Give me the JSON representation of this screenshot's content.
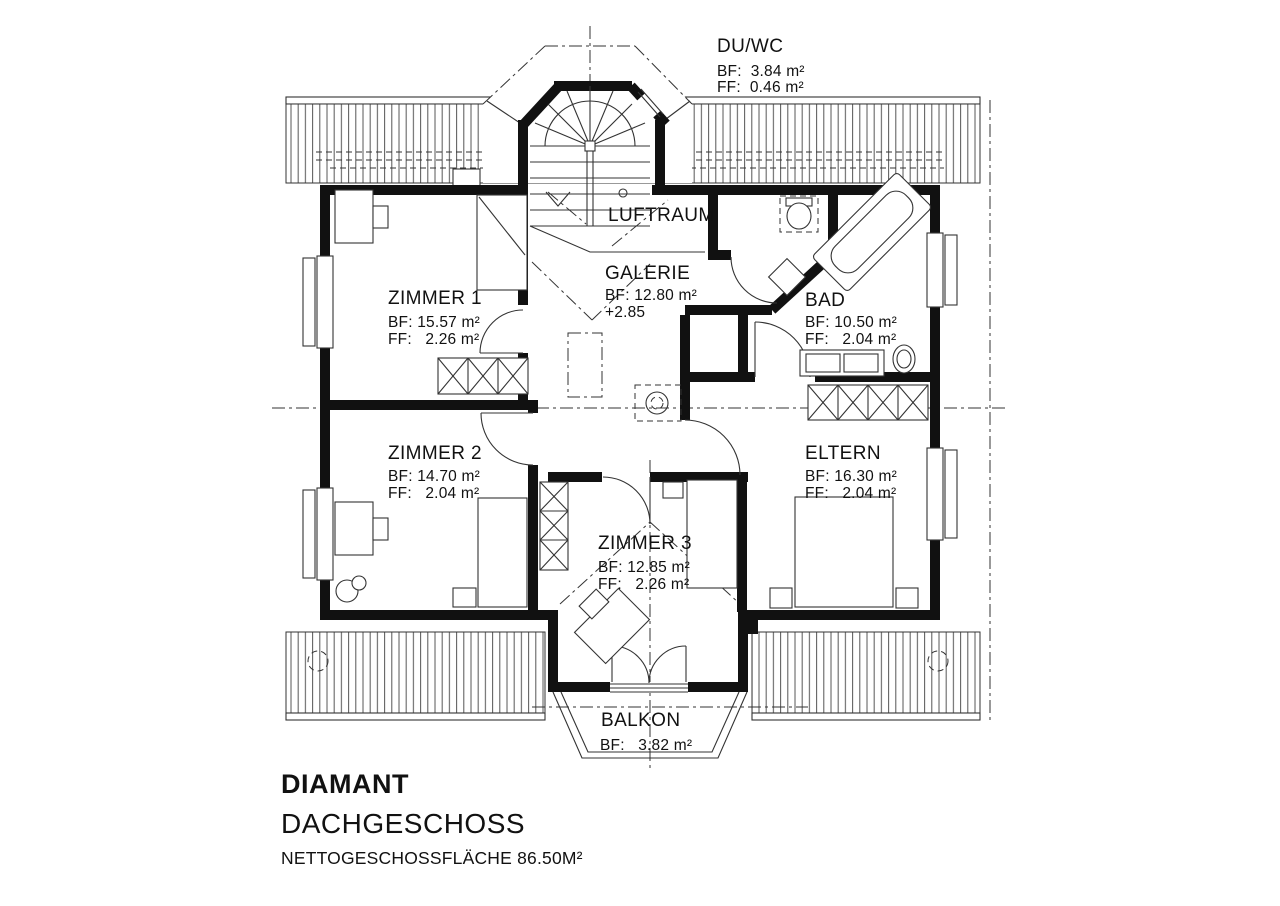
{
  "title": {
    "project": "DIAMANT",
    "floor": "DACHGESCHOSS",
    "area": "NETTOGESCHOSSFLÄCHE 86.50M²"
  },
  "rooms": {
    "duwc": {
      "name": "DU/WC",
      "bf": "BF:  3.84 m²",
      "ff": "FF:  0.46 m²"
    },
    "luftraum": {
      "name": "LUFTRAUM"
    },
    "galerie": {
      "name": "GALERIE",
      "bf": "BF: 12.80 m²",
      "level": "+2.85"
    },
    "zimmer1": {
      "name": "ZIMMER 1",
      "bf": "BF: 15.57 m²",
      "ff": "FF:   2.26 m²"
    },
    "bad": {
      "name": "BAD",
      "bf": "BF: 10.50 m²",
      "ff": "FF:   2.04 m²"
    },
    "zimmer2": {
      "name": "ZIMMER 2",
      "bf": "BF: 14.70 m²",
      "ff": "FF:   2.04 m²"
    },
    "eltern": {
      "name": "ELTERN",
      "bf": "BF: 16.30 m²",
      "ff": "FF:   2.04 m²"
    },
    "zimmer3": {
      "name": "ZIMMER 3",
      "bf": "BF: 12.85 m²",
      "ff": "FF:   2.26 m²"
    },
    "balkon": {
      "name": "BALKON",
      "bf": "BF:   3.82 m²"
    }
  },
  "colors": {
    "ink": "#111111",
    "line": "#333333",
    "background": "#ffffff"
  }
}
